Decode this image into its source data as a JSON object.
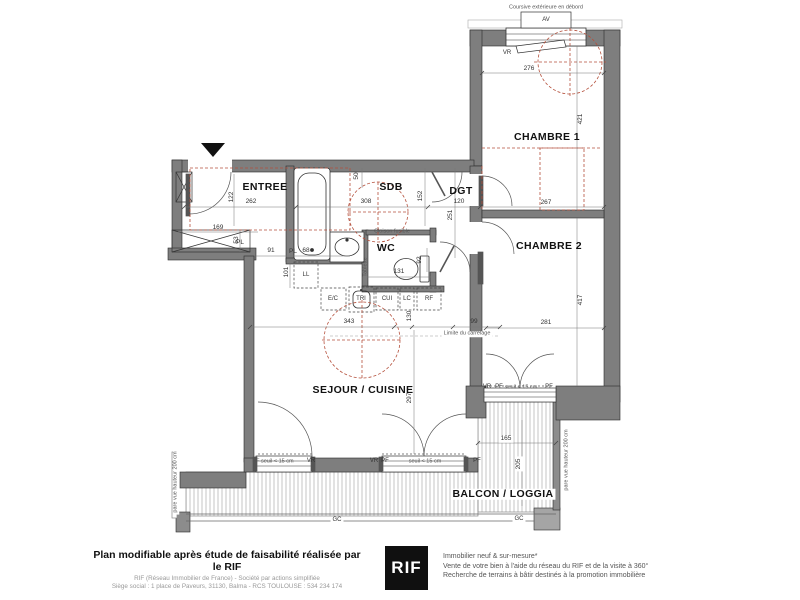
{
  "plan": {
    "colors": {
      "wall": "#7e7e7e",
      "red_dashed": "#b5503c",
      "dim_line": "#777777",
      "hatch": "#b5b5b5"
    },
    "labels": [
      {
        "name": "room-label-entree",
        "text": "ENTREE",
        "x": 265,
        "y": 187,
        "cls": "room"
      },
      {
        "name": "room-label-sdb",
        "text": "SDB",
        "x": 391,
        "y": 187,
        "cls": "room"
      },
      {
        "name": "room-label-dgt",
        "text": "DGT",
        "x": 461,
        "y": 191,
        "cls": "room"
      },
      {
        "name": "room-label-wc",
        "text": "WC",
        "x": 386,
        "y": 248,
        "cls": "room"
      },
      {
        "name": "room-label-chambre1",
        "text": "CHAMBRE 1",
        "x": 547,
        "y": 137,
        "cls": "room"
      },
      {
        "name": "room-label-chambre2",
        "text": "CHAMBRE 2",
        "x": 549,
        "y": 246,
        "cls": "room"
      },
      {
        "name": "room-label-sejour-cuisine",
        "text": "SEJOUR / CUISINE",
        "x": 363,
        "y": 390,
        "cls": "room"
      },
      {
        "name": "room-label-balcon-loggia",
        "text": "BALCON / LOGGIA",
        "x": 503,
        "y": 494,
        "cls": "room",
        "bg": true
      },
      {
        "name": "dim-262",
        "text": "262",
        "x": 251,
        "y": 202,
        "cls": "dim"
      },
      {
        "name": "dim-122",
        "text": "122",
        "x": 232,
        "y": 197,
        "cls": "dim",
        "rot": true
      },
      {
        "name": "dim-308",
        "text": "308",
        "x": 366,
        "y": 202,
        "cls": "dim"
      },
      {
        "name": "dim-152",
        "text": "152",
        "x": 421,
        "y": 196,
        "cls": "dim",
        "rot": true
      },
      {
        "name": "dim-120",
        "text": "120",
        "x": 459,
        "y": 202,
        "cls": "dim"
      },
      {
        "name": "dim-267",
        "text": "267",
        "x": 546,
        "y": 203,
        "cls": "dim"
      },
      {
        "name": "dim-276",
        "text": "276",
        "x": 529,
        "y": 69,
        "cls": "dim"
      },
      {
        "name": "dim-421",
        "text": "421",
        "x": 581,
        "y": 119,
        "cls": "dim",
        "rot": true
      },
      {
        "name": "dim-417",
        "text": "417",
        "x": 581,
        "y": 300,
        "cls": "dim",
        "rot": true
      },
      {
        "name": "dim-281",
        "text": "281",
        "x": 546,
        "y": 323,
        "cls": "dim"
      },
      {
        "name": "dim-251",
        "text": "251",
        "x": 451,
        "y": 215,
        "cls": "dim",
        "rot": true
      },
      {
        "name": "dim-169",
        "text": "169",
        "x": 218,
        "y": 228,
        "cls": "dim"
      },
      {
        "name": "dim-53",
        "text": "53",
        "x": 237,
        "y": 240,
        "cls": "dim",
        "rot": true
      },
      {
        "name": "dim-91",
        "text": "91",
        "x": 271,
        "y": 251,
        "cls": "dim"
      },
      {
        "name": "closet-label-pl-1",
        "text": "PL",
        "x": 240,
        "y": 243,
        "cls": "dim"
      },
      {
        "name": "closet-label-pl-2",
        "text": "PL",
        "x": 293,
        "y": 252,
        "cls": "dim"
      },
      {
        "name": "dim-68",
        "text": "68",
        "x": 306,
        "y": 251,
        "cls": "dim"
      },
      {
        "name": "dim-101",
        "text": "101",
        "x": 287,
        "y": 272,
        "cls": "dim",
        "rot": true
      },
      {
        "name": "dim-131",
        "text": "131",
        "x": 399,
        "y": 272,
        "cls": "dim"
      },
      {
        "name": "dim-92",
        "text": "92",
        "x": 420,
        "y": 260,
        "cls": "dim",
        "rot": true
      },
      {
        "name": "dim-50",
        "text": "50",
        "x": 357,
        "y": 176,
        "cls": "dim",
        "rot": true
      },
      {
        "name": "dim-343",
        "text": "343",
        "x": 349,
        "y": 322,
        "cls": "dim"
      },
      {
        "name": "dim-130",
        "text": "130",
        "x": 410,
        "y": 316,
        "cls": "dim",
        "rot": true
      },
      {
        "name": "dim-99",
        "text": "99",
        "x": 474,
        "y": 322,
        "cls": "dim"
      },
      {
        "name": "dim-297",
        "text": "297",
        "x": 410,
        "y": 398,
        "cls": "dim",
        "rot": true
      },
      {
        "name": "dim-165",
        "text": "165",
        "x": 506,
        "y": 439,
        "cls": "dim",
        "bg": true
      },
      {
        "name": "dim-205",
        "text": "205",
        "x": 519,
        "y": 464,
        "cls": "dim",
        "rot": true,
        "bg": true
      },
      {
        "name": "note-coursive",
        "text": "Coursive extérieure en débord",
        "x": 546,
        "y": 8,
        "cls": "tiny"
      },
      {
        "name": "window-label-av",
        "text": "AV",
        "x": 546,
        "y": 20,
        "cls": "note"
      },
      {
        "name": "shutter-label-vr-ch1",
        "text": "VR",
        "x": 507,
        "y": 53,
        "cls": "note"
      },
      {
        "name": "appliance-label-ll",
        "text": "LL",
        "x": 306,
        "y": 275,
        "cls": "note"
      },
      {
        "name": "appliance-label-ec",
        "text": "E/C",
        "x": 333,
        "y": 299,
        "cls": "note"
      },
      {
        "name": "appliance-label-tri",
        "text": "TRI",
        "x": 361,
        "y": 299,
        "cls": "note"
      },
      {
        "name": "appliance-label-cui",
        "text": "CUI",
        "x": 387,
        "y": 299,
        "cls": "note"
      },
      {
        "name": "appliance-label-lc",
        "text": "LC",
        "x": 407,
        "y": 299,
        "cls": "note"
      },
      {
        "name": "appliance-label-rf",
        "text": "RF",
        "x": 429,
        "y": 299,
        "cls": "note"
      },
      {
        "name": "note-cloison-fusible",
        "text": "Cloison fusible",
        "x": 392,
        "y": 232,
        "cls": "tiny"
      },
      {
        "name": "note-tablette",
        "text": "Tablette",
        "x": 366,
        "y": 267,
        "cls": "tiny",
        "rot": true
      },
      {
        "name": "note-limite-carrelage",
        "text": "Limite du carrelage",
        "x": 467,
        "y": 334,
        "cls": "tiny",
        "bg": true
      },
      {
        "name": "note-pf-seuil-left",
        "text": "PF seuil < 15 cm",
        "x": 273,
        "y": 462,
        "cls": "tiny"
      },
      {
        "name": "shutter-label-vr-win1",
        "text": "VR",
        "x": 311,
        "y": 461,
        "cls": "note"
      },
      {
        "name": "shutter-label-vr-win2",
        "text": "VR",
        "x": 374,
        "y": 461,
        "cls": "note"
      },
      {
        "name": "window-label-pf-win2a",
        "text": "PF",
        "x": 385,
        "y": 461,
        "cls": "note"
      },
      {
        "name": "note-pf-seuil-mid",
        "text": "seuil < 15 cm",
        "x": 425,
        "y": 462,
        "cls": "tiny"
      },
      {
        "name": "window-label-pf-win2b",
        "text": "PF",
        "x": 477,
        "y": 461,
        "cls": "note"
      },
      {
        "name": "shutter-label-vr-ch2",
        "text": "VR",
        "x": 487,
        "y": 387,
        "cls": "note"
      },
      {
        "name": "window-label-pf-ch2a",
        "text": "PF",
        "x": 499,
        "y": 387,
        "cls": "note"
      },
      {
        "name": "note-pf-seuil-ch2",
        "text": "seuil < 15 cm",
        "x": 521,
        "y": 388,
        "cls": "tiny"
      },
      {
        "name": "window-label-pf-ch2b",
        "text": "PF",
        "x": 549,
        "y": 387,
        "cls": "note"
      },
      {
        "name": "note-gc-left",
        "text": "GC",
        "x": 337,
        "y": 520,
        "cls": "note",
        "bg": true
      },
      {
        "name": "note-gc-right",
        "text": "GC",
        "x": 519,
        "y": 519,
        "cls": "note",
        "bg": true
      },
      {
        "name": "note-pare-vue-left",
        "text": "pare vue hauteur 200 cm",
        "x": 176,
        "y": 482,
        "cls": "tiny",
        "rot": true,
        "bg": true
      },
      {
        "name": "note-pare-vue-right",
        "text": "pare vue hauteur 200 cm",
        "x": 567,
        "y": 460,
        "cls": "tiny",
        "rot": true
      }
    ]
  },
  "footer": {
    "left_bold": "Plan modifiable après étude de faisabilité réalisée par le RIF",
    "left_line2": "RIF (Réseau Immobilier de France) - Société par actions simplifiée",
    "left_line3": "Siège social : 1 place de Paveurs, 31130, Balma - RCS TOULOUSE : 534 234 174",
    "logo_text": "RIF",
    "right_lines": [
      "Immobilier neuf & sur-mesure*",
      "Vente de votre bien à l'aide du réseau du RIF et de la visite à 360°",
      "Recherche de terrains à bâtir destinés à la promotion immobilière"
    ]
  }
}
